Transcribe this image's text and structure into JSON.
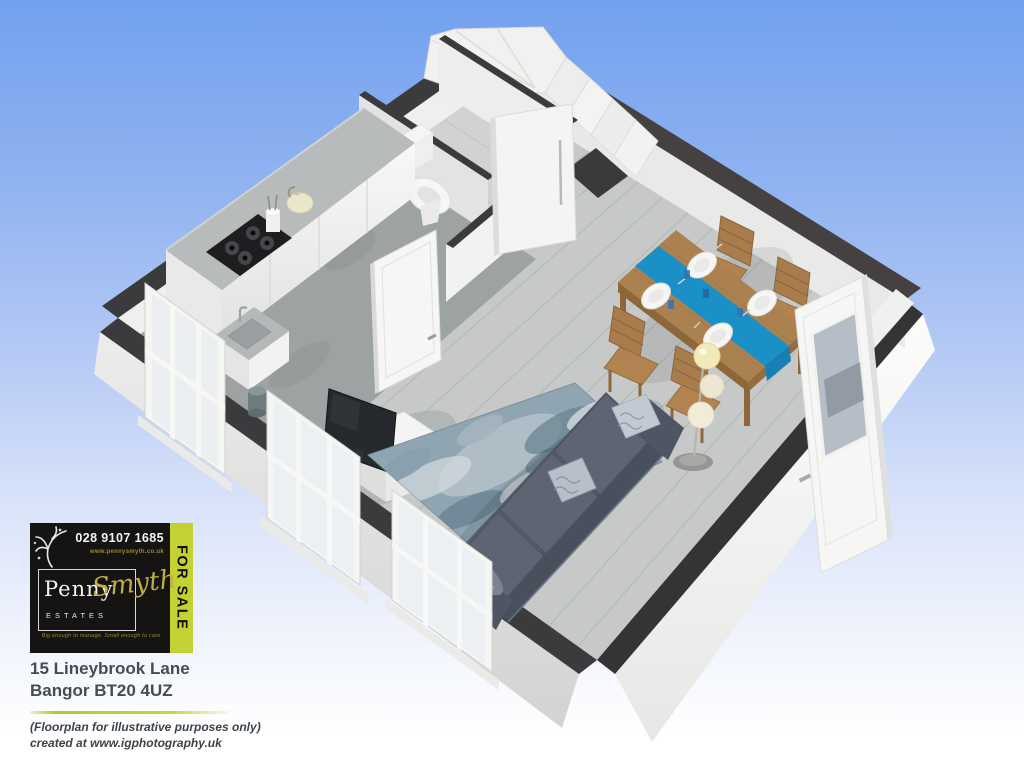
{
  "sale_board": {
    "phone": "028 9107 1685",
    "website": "www.pennysmyth.co.uk",
    "brand_first": "Penny",
    "brand_second": "Smyth",
    "brand_suffix": "ESTATES",
    "tagline": "Big enough to manage.   Small enough to care",
    "for_sale": "FOR SALE"
  },
  "property": {
    "address_line1": "15 Lineybrook Lane",
    "address_line2": "Bangor BT20 4UZ"
  },
  "disclaimer": {
    "line1": "(Floorplan for illustrative purposes only)",
    "line2": "created at www.igphotography.uk"
  },
  "colors": {
    "sky_top": "#73a1ee",
    "sky_bottom": "#ffffff",
    "board_bg": "#161413",
    "for_sale_bg": "#c3d232",
    "brand_gold": "#c0ad45",
    "wall_top": "#3b3b3d",
    "runner_blue": "#1b90c7",
    "sofa_gray": "#565d6a",
    "wood": "#ab8150"
  },
  "scene": {
    "type": "3d-floorplan-render",
    "rooms": [
      "kitchen",
      "wc",
      "stair-hall",
      "dining-area",
      "living-area"
    ],
    "furniture": [
      "kitchen-counter",
      "gas-hob",
      "kettle",
      "utensil-pot",
      "sink",
      "waste-bin",
      "toilet",
      "staircase",
      "dining-table",
      "table-runner",
      "dinner-plates",
      "dining-chairs",
      "floor-lamp",
      "area-rug",
      "sofa",
      "throw-pillows",
      "tv",
      "tv-stand"
    ],
    "openings": [
      "kitchen-door",
      "hall-door",
      "glazed-exterior-door",
      "window-kitchen",
      "window-living-left",
      "window-living-front"
    ]
  }
}
